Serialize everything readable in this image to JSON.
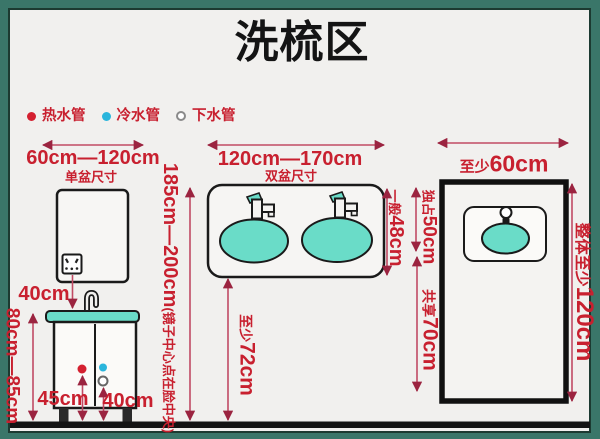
{
  "title": "洗梳区",
  "legend": {
    "hot_label": "热水管",
    "cold_label": "冷水管",
    "drain_label": "下水管"
  },
  "single_basin": {
    "width_range": "60cm—120cm",
    "caption": "单盆尺寸",
    "mirror_to_basin_gap": "40cm",
    "counter_height_range": "80cm—85cm",
    "hot_pipe_height": "45cm",
    "drain_pipe_height": "40cm"
  },
  "double_basin": {
    "width_range": "120cm—170cm",
    "caption": "双盆尺寸",
    "mirror_height_range": "185cm—200cm",
    "mirror_note": "(镜子中心点在脸中央)",
    "counter_depth_prefix": "一般",
    "counter_depth": "48cm",
    "front_clearance_prefix": "至少",
    "front_clearance": "72cm"
  },
  "top_view": {
    "min_width_prefix": "至少",
    "min_width": "60cm",
    "exclusive_prefix": "独占",
    "exclusive_width": "50cm",
    "shared_prefix": "共享",
    "shared_width": "70cm",
    "overall_prefix": "整体至少",
    "overall_length": "120cm"
  },
  "colors": {
    "background_teal": "#3A7669",
    "panel": "#F1F0EE",
    "label_red": "#C8202F",
    "dimension_pink": "#C14A64",
    "arrowhead": "#9B2440",
    "basin_teal": "#6ADCC8",
    "hot_dot_red": "#D42030",
    "cold_dot_cyan": "#2AB5DC",
    "outline_black": "#1A1A1A"
  }
}
